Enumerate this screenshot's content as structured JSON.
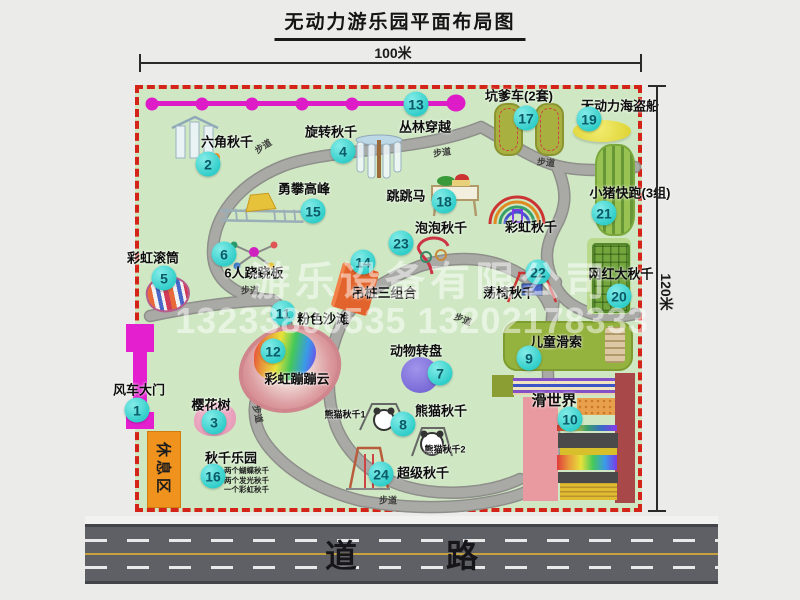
{
  "title": "无动力游乐园平面布局图",
  "measurements": {
    "top": "100米",
    "right": "120米"
  },
  "trail_label": "步道",
  "road_label": "道 路",
  "rest_area_label": "休息区",
  "rainbow_swing_label": "彩虹秋千",
  "watermark": {
    "company": "游乐设备有限公司",
    "phones": "13233800535 13202178333"
  },
  "colors": {
    "map_green": "#cfe8c3",
    "border_red": "#d42318",
    "badge_cyan": "#2fcdc9",
    "magenta": "#e41fd0",
    "path_gray": "#a9a9a5",
    "rest_orange": "#f0921e",
    "road_gray": "#5f5f66",
    "beach_pink": "#e2a0a2"
  },
  "attractions": [
    {
      "num": "1",
      "name": "风车大门"
    },
    {
      "num": "2",
      "name": "六角秋千"
    },
    {
      "num": "3",
      "name": "樱花树"
    },
    {
      "num": "4",
      "name": "旋转秋千"
    },
    {
      "num": "5",
      "name": "彩虹滚筒"
    },
    {
      "num": "6",
      "name": "6人跷跷板"
    },
    {
      "num": "7",
      "name": "动物转盘"
    },
    {
      "num": "8",
      "name": "熊猫秋千",
      "subs": [
        "熊猫秋千1",
        "熊猫秋千2"
      ]
    },
    {
      "num": "9",
      "name": "儿童滑索"
    },
    {
      "num": "10",
      "name": "滑世界"
    },
    {
      "num": "11",
      "name": "粉色沙滩"
    },
    {
      "num": "12",
      "name": "彩虹蹦蹦云"
    },
    {
      "num": "13",
      "name": "丛林穿越"
    },
    {
      "num": "14",
      "name": "吊桩三组合"
    },
    {
      "num": "15",
      "name": "勇攀高峰"
    },
    {
      "num": "16",
      "name": "秋千乐园",
      "notes": [
        "两个蝴蝶秋千",
        "两个发光秋千",
        "一个彩虹秋千"
      ]
    },
    {
      "num": "17",
      "name": "坑爹车(2套)"
    },
    {
      "num": "18",
      "name": "跳跳马"
    },
    {
      "num": "19",
      "name": "无动力海盗船"
    },
    {
      "num": "20",
      "name": "网红大秋千"
    },
    {
      "num": "21",
      "name": "小猪快跑(3组)"
    },
    {
      "num": "22",
      "name": "荡椅秋千"
    },
    {
      "num": "23",
      "name": "泡泡秋千"
    },
    {
      "num": "24",
      "name": "超级秋千"
    }
  ]
}
